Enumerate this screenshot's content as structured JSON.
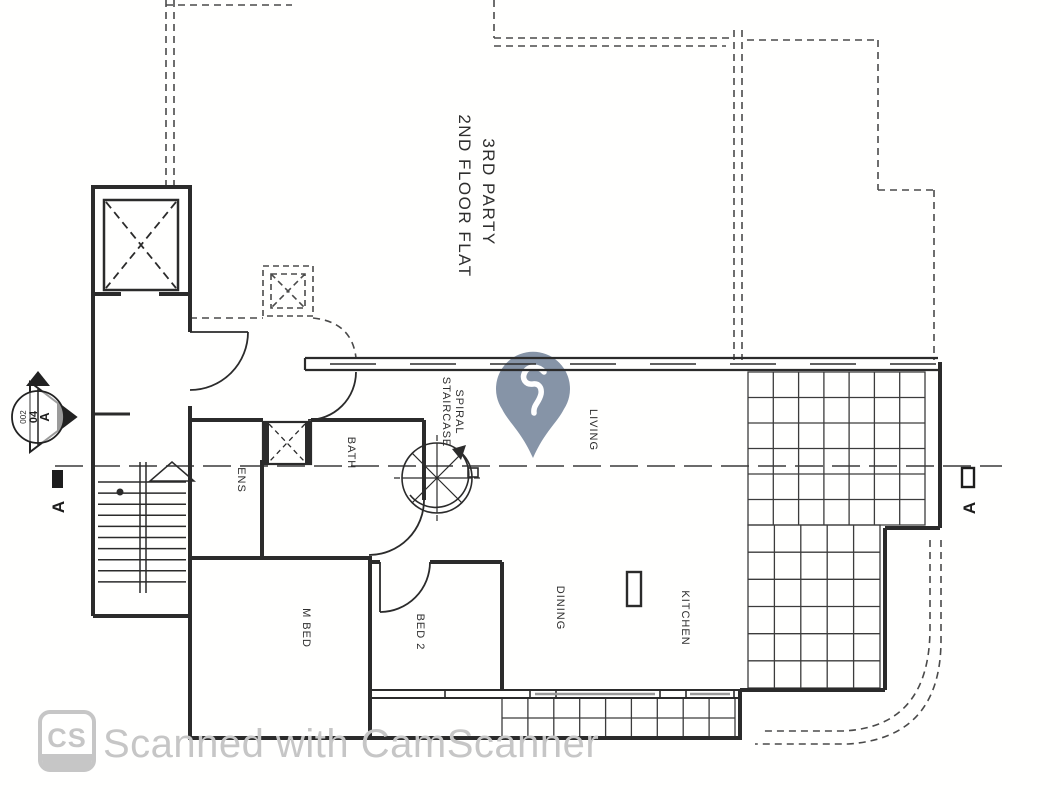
{
  "title_block": {
    "line1": "3RD PARTY",
    "line2": "2ND FLOOR FLAT"
  },
  "rooms": {
    "living": "LIVING",
    "bath": "BATH",
    "ens": "ENS",
    "m_bed": "M BED",
    "bed2": "BED 2",
    "dining": "DINING",
    "kitchen": "KITCHEN",
    "spiral_line1": "SPIRAL",
    "spiral_line2": "STAIRCASE"
  },
  "section_markers": {
    "circle_line1": "A",
    "circle_line2": "04",
    "circle_line3": "002",
    "left_letter": "A",
    "right_letter": "A"
  },
  "watermark": {
    "text": "Scanned with CamScanner",
    "logo": "CS",
    "color": "#c6c6c6"
  },
  "pin": {
    "color": "#8694a7"
  },
  "drawing": {
    "wall_color": "#2b2b2b",
    "dash_color": "#4a4a4a",
    "background": "#fffffe"
  }
}
